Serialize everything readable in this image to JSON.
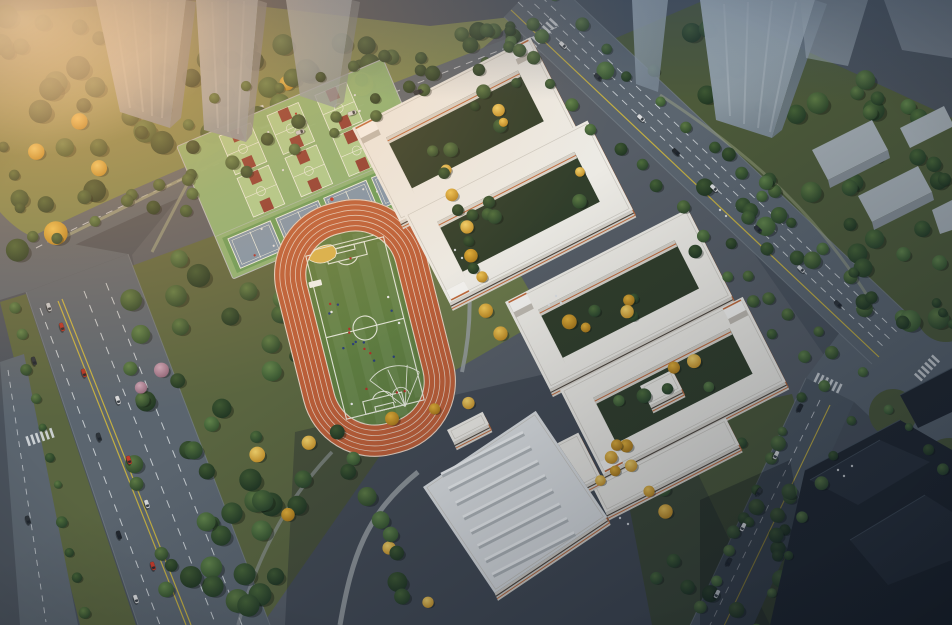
{
  "scene": {
    "type": "architectural-aerial-rendering",
    "subject": "school campus bird's-eye view at dusk",
    "lighting": "warm sunset glow from upper-left, cool blue dusk shadow toward lower-right",
    "inventory": {
      "running_track": 1,
      "soccer_field": 1,
      "long_jump_sand_pit": 1,
      "throwing_sector": 1,
      "basketball_courts": 6,
      "blue_courts": 4,
      "courtyard_teaching_building_complexes": 2,
      "annex_buildings": 3,
      "gymnasium_with_ribbed_roof": 1,
      "glass_towers_top": 7,
      "dark_towers_bottom_right": 3,
      "roads": [
        "left boulevard with planted median",
        "top perimeter road",
        "right arterial road",
        "bottom-right road",
        "signalized intersection with zebra crossings"
      ]
    }
  },
  "palette": {
    "base": "#4a525c",
    "campus": "#565d66",
    "parkGrass": "#7a8650",
    "parkGrassDark": "#5a6540",
    "forestGrass": "#4d5a3a",
    "road": "#5b656f",
    "roadDark": "#4e5862",
    "laneWhite": "#d6dade",
    "laneYellow": "#c2ae42",
    "sidewalk": "#79828b",
    "trackOrange": "#bb5e38",
    "trackLine": "#eadfd2",
    "infield": "#5f7d41",
    "pitchLine": "#e8eadf",
    "sand": "#d8b24c",
    "padGreen": "#8cb677",
    "bbCourt": "#a9cd91",
    "bbKey": "#8c3a31",
    "courtLine": "#edf2e8",
    "tnStrip": "#679d5a",
    "tnCourt": "#7d95ac",
    "roofWhite": "#eceae4",
    "gymRoof": "#dde0e2",
    "wallLight": "#d6d2ca",
    "wallDark": "#beb9b0",
    "accentOrange": "#bf6a3c",
    "windowDark": "#4d453c",
    "courtyard": "#313e2b",
    "towerFace": "#7d8a96",
    "lowrise": "#a2abb1",
    "lowriseSide": "#828b92",
    "darkTower": "#21272f",
    "darkTower2": "#2b323c",
    "darkTowerEdge": "#4a5560",
    "gymRib": "#eff1f2",
    "gymRibShade": "#b2b7ba",
    "pathGray": "#999fa2",
    "pathPark": "#a2a887",
    "glow": "#ffb066",
    "glowCore": "#ffdcae",
    "dusk": "#0a1423",
    "topCool": "#32445c",
    "flagRed": "#c13227",
    "playerRed": "#b03028",
    "playerBlue": "#2a3e7a",
    "playerWhite": "#e8e8e8",
    "pedestrian": "#dde0e3",
    "bumpWhite": "#f4f3f0"
  },
  "sports": {
    "track_lanes": 6,
    "lane_width": 5.2,
    "field_players": 22,
    "court_players": 14,
    "basketball": {
      "rows": 2,
      "cols": 3,
      "court_w": 34,
      "court_h": 42,
      "row_centers": [
        -44,
        2
      ],
      "col_centers": [
        -52,
        0,
        52
      ]
    },
    "tennis": {
      "count": 4,
      "court_w": 46,
      "court_h": 32,
      "centers_x": [
        -78,
        -26,
        26,
        78
      ],
      "center_y": 49,
      "strip": [
        -106,
        30,
        212,
        38
      ]
    }
  },
  "buildings": [
    {
      "name": "teaching-building-a-north-ring",
      "ang": -27,
      "o": [
        352,
        128
      ],
      "U": 200,
      "V": 105,
      "iU": 26,
      "iV": 24,
      "courtyard": true,
      "bumps": [
        0,
        1
      ],
      "roof": "roofWhite"
    },
    {
      "name": "teaching-building-a-south-ring",
      "ang": -27,
      "o": [
        404,
        214
      ],
      "U": 206,
      "V": 100,
      "iU": 26,
      "iV": 22,
      "courtyard": true,
      "bumps": [
        3
      ],
      "roof": "roofWhite"
    },
    {
      "name": "teaching-building-b-north-ring",
      "ang": -27,
      "o": [
        505,
        302
      ],
      "U": 205,
      "V": 98,
      "iU": 26,
      "iV": 22,
      "courtyard": true,
      "bumps": [
        0
      ],
      "roof": "roofWhite"
    },
    {
      "name": "teaching-building-b-south-ring",
      "ang": -27,
      "o": [
        560,
        390
      ],
      "U": 205,
      "V": 95,
      "iU": 26,
      "iV": 22,
      "courtyard": true,
      "bumps": [
        3,
        1
      ],
      "roof": "roofWhite"
    },
    {
      "name": "annex-bar-long",
      "ang": -27,
      "o": [
        592,
        486
      ],
      "U": 150,
      "V": 30,
      "courtyard": false,
      "bumps": [],
      "roof": "roofWhite"
    },
    {
      "name": "annex-bar-short",
      "ang": -27,
      "o": [
        548,
        448
      ],
      "U": 34,
      "V": 50,
      "courtyard": false,
      "bumps": [],
      "roof": "roofWhite"
    },
    {
      "name": "annex-block-small",
      "ang": -27,
      "o": [
        640,
        386
      ],
      "U": 36,
      "V": 22,
      "courtyard": false,
      "bumps": [],
      "roof": "roofWhite"
    },
    {
      "name": "gymnasium",
      "ang": -34,
      "o": [
        423,
        487
      ],
      "U": 136,
      "V": 128,
      "courtyard": false,
      "bumps": [],
      "roof": "gymRoof"
    },
    {
      "name": "entrance-canopy",
      "ang": -27,
      "o": [
        447,
        430
      ],
      "U": 40,
      "V": 14,
      "courtyard": false,
      "bumps": [],
      "roof": "roofWhite"
    }
  ],
  "gym_ribs": {
    "count": 8,
    "start": [
      441,
      474
    ],
    "step": [
      7.3,
      14.3
    ],
    "len": [
      82,
      -41.8
    ]
  },
  "vegetation": {
    "greens": [
      [
        "#5d7a44",
        "#2c452a"
      ],
      [
        "#4f6e3c",
        "#27402a"
      ],
      [
        "#466337",
        "#233a26"
      ],
      [
        "#60824a",
        "#33502e"
      ],
      [
        "#3e5832",
        "#1f3422"
      ]
    ],
    "yellows": [
      [
        "#eec455",
        "#b5821f"
      ],
      [
        "#e0ae39",
        "#a37318"
      ],
      [
        "#f0d06a",
        "#c08c26"
      ]
    ],
    "pink": [
      "#c9a3b4",
      "#8f6478"
    ],
    "patches": [
      {
        "layer": "back",
        "kind": "mixg",
        "poly": [
          [
            0,
            12
          ],
          [
            205,
            0
          ],
          [
            430,
            26
          ],
          [
            520,
            16
          ],
          [
            432,
            92
          ],
          [
            236,
            140
          ],
          [
            58,
            250
          ],
          [
            0,
            266
          ]
        ],
        "n": 64,
        "rmin": 6,
        "rmax": 12
      },
      {
        "layer": "back",
        "kind": "g",
        "poly": [
          [
            126,
            266
          ],
          [
            322,
            196
          ],
          [
            402,
            424
          ],
          [
            262,
            625
          ],
          [
            166,
            625
          ],
          [
            116,
            420
          ]
        ],
        "n": 58,
        "rmin": 6,
        "rmax": 12
      },
      {
        "layer": "back",
        "kind": "y",
        "poly": [
          [
            200,
            420
          ],
          [
            330,
            380
          ],
          [
            360,
            480
          ],
          [
            240,
            560
          ]
        ],
        "n": 3,
        "rmin": 6,
        "rmax": 8
      },
      {
        "layer": "back",
        "kind": "p",
        "poly": [
          [
            130,
            300
          ],
          [
            230,
            330
          ],
          [
            210,
            420
          ],
          [
            120,
            400
          ]
        ],
        "n": 2,
        "rmin": 6,
        "rmax": 8
      },
      {
        "layer": "back",
        "kind": "g",
        "poly": [
          [
            560,
            60
          ],
          [
            700,
            2
          ],
          [
            952,
            118
          ],
          [
            952,
            332
          ],
          [
            878,
            348
          ],
          [
            636,
            132
          ]
        ],
        "n": 52,
        "rmin": 6,
        "rmax": 11
      },
      {
        "layer": "back",
        "kind": "g",
        "poly": [
          [
            615,
            432
          ],
          [
            790,
            395
          ],
          [
            842,
            560
          ],
          [
            842,
            625
          ],
          [
            652,
            625
          ]
        ],
        "n": 26,
        "rmin": 5,
        "rmax": 9
      },
      {
        "layer": "back",
        "kind": "g",
        "poly": [
          [
            360,
            52
          ],
          [
            560,
            12
          ],
          [
            640,
            40
          ],
          [
            470,
            90
          ]
        ],
        "n": 10,
        "rmin": 5,
        "rmax": 8
      },
      {
        "layer": "front",
        "kind": "mix",
        "poly": [
          [
            386,
            138
          ],
          [
            518,
            71
          ],
          [
            544,
            122
          ],
          [
            412,
            189
          ]
        ],
        "n": 7,
        "rmin": 4.5,
        "rmax": 7.5
      },
      {
        "layer": "front",
        "kind": "mix",
        "poly": [
          [
            437,
            222
          ],
          [
            574,
            152
          ],
          [
            599,
            202
          ],
          [
            462,
            272
          ]
        ],
        "n": 7,
        "rmin": 4.5,
        "rmax": 7.5
      },
      {
        "layer": "front",
        "kind": "mix",
        "poly": [
          [
            538,
            310
          ],
          [
            674,
            241
          ],
          [
            697,
            285
          ],
          [
            561,
            354
          ]
        ],
        "n": 7,
        "rmin": 4.5,
        "rmax": 7.5
      },
      {
        "layer": "front",
        "kind": "mix",
        "poly": [
          [
            593,
            398
          ],
          [
            729,
            328
          ],
          [
            750,
            370
          ],
          [
            614,
            440
          ]
        ],
        "n": 7,
        "rmin": 4.5,
        "rmax": 7.5
      },
      {
        "layer": "front",
        "kind": "y",
        "poly": [
          [
            560,
            470
          ],
          [
            640,
            432
          ],
          [
            663,
            456
          ],
          [
            585,
            496
          ]
        ],
        "n": 4,
        "rmin": 5,
        "rmax": 7
      }
    ],
    "belts": [
      {
        "layer": "front",
        "kind": "g",
        "pts": [
          [
            505,
            44
          ],
          [
            858,
            374
          ]
        ],
        "n": 17,
        "rmin": 5,
        "rmax": 7,
        "jit": 7
      },
      {
        "layer": "front",
        "kind": "g",
        "pts": [
          [
            550,
            -2
          ],
          [
            903,
            328
          ]
        ],
        "n": 14,
        "rmin": 5,
        "rmax": 7,
        "jit": 6
      },
      {
        "layer": "front",
        "kind": "g",
        "pts": [
          [
            60,
            236
          ],
          [
            540,
            20
          ]
        ],
        "n": 15,
        "rmin": 5,
        "rmax": 8,
        "jit": 7
      },
      {
        "layer": "front",
        "kind": "g",
        "pts": [
          [
            150,
            208
          ],
          [
            520,
            56
          ]
        ],
        "n": 9,
        "rmin": 5,
        "rmax": 7,
        "jit": 6
      },
      {
        "layer": "front",
        "kind": "g",
        "pts": [
          [
            14,
            306
          ],
          [
            86,
            610
          ]
        ],
        "n": 11,
        "rmin": 4,
        "rmax": 6,
        "jit": 4
      },
      {
        "layer": "front",
        "kind": "g",
        "pts": [
          [
            798,
            402
          ],
          [
            704,
            608
          ]
        ],
        "n": 8,
        "rmin": 4.5,
        "rmax": 7,
        "jit": 5
      },
      {
        "layer": "front",
        "kind": "g",
        "pts": [
          [
            848,
            418
          ],
          [
            758,
            625
          ]
        ],
        "n": 7,
        "rmin": 4.5,
        "rmax": 7,
        "jit": 5
      },
      {
        "layer": "front",
        "kind": "y",
        "pts": [
          [
            447,
            168
          ],
          [
            500,
            338
          ]
        ],
        "n": 7,
        "rmin": 5.5,
        "rmax": 7.5,
        "jit": 6
      },
      {
        "layer": "front",
        "kind": "y",
        "pts": [
          [
            396,
            420
          ],
          [
            470,
            402
          ]
        ],
        "n": 3,
        "rmin": 5.5,
        "rmax": 7.5,
        "jit": 4
      },
      {
        "layer": "front",
        "kind": "y",
        "pts": [
          [
            618,
            448
          ],
          [
            666,
            512
          ]
        ],
        "n": 4,
        "rmin": 5.5,
        "rmax": 7.5,
        "jit": 5
      },
      {
        "layer": "front",
        "kind": "y",
        "pts": [
          [
            386,
            548
          ],
          [
            428,
            602
          ]
        ],
        "n": 2,
        "rmin": 5.5,
        "rmax": 7,
        "jit": 4
      },
      {
        "layer": "front",
        "kind": "g",
        "pts": [
          [
            192,
            122
          ],
          [
            186,
            206
          ]
        ],
        "n": 4,
        "rmin": 5,
        "rmax": 7,
        "jit": 5
      },
      {
        "layer": "front",
        "kind": "g",
        "pts": [
          [
            214,
            98
          ],
          [
            420,
            52
          ]
        ],
        "n": 7,
        "rmin": 5,
        "rmax": 7,
        "jit": 6
      },
      {
        "layer": "front",
        "kind": "g",
        "pts": [
          [
            432,
            148
          ],
          [
            476,
            268
          ]
        ],
        "n": 5,
        "rmin": 5,
        "rmax": 7,
        "jit": 5
      },
      {
        "layer": "front",
        "kind": "g",
        "pts": [
          [
            698,
            252
          ],
          [
            826,
            388
          ]
        ],
        "n": 6,
        "rmin": 5,
        "rmax": 7,
        "jit": 6
      },
      {
        "layer": "front",
        "kind": "g",
        "pts": [
          [
            338,
            436
          ],
          [
            410,
            596
          ]
        ],
        "n": 9,
        "rmin": 6,
        "rmax": 10,
        "jit": 8
      },
      {
        "layer": "front",
        "kind": "g",
        "pts": [
          [
            890,
            412
          ],
          [
            942,
            468
          ]
        ],
        "n": 4,
        "rmin": 4,
        "rmax": 6,
        "jit": 4
      },
      {
        "layer": "front",
        "kind": "g",
        "pts": [
          [
            938,
            302
          ],
          [
            952,
            322
          ]
        ],
        "n": 3,
        "rmin": 4,
        "rmax": 5,
        "jit": 3
      },
      {
        "layer": "front",
        "kind": "g",
        "pts": [
          [
            6,
            146
          ],
          [
            30,
            236
          ]
        ],
        "n": 4,
        "rmin": 5,
        "rmax": 7,
        "jit": 4
      }
    ]
  },
  "cars": [
    [
      49,
      307,
      71,
      "#c3c8cc"
    ],
    [
      62,
      327,
      71,
      "#b23527"
    ],
    [
      34,
      361,
      71,
      "#2e343a"
    ],
    [
      84,
      373,
      71,
      "#b23527"
    ],
    [
      118,
      400,
      71,
      "#d8dadc"
    ],
    [
      99,
      437,
      71,
      "#2e343a"
    ],
    [
      129,
      460,
      71,
      "#c23b2b"
    ],
    [
      147,
      504,
      71,
      "#d8dadc"
    ],
    [
      119,
      535,
      71,
      "#23282e"
    ],
    [
      153,
      566,
      71,
      "#c23b2b"
    ],
    [
      136,
      599,
      71,
      "#d8dadc"
    ],
    [
      28,
      520,
      71,
      "#2e343a"
    ],
    [
      563,
      45,
      43,
      "#d8dadc"
    ],
    [
      598,
      77,
      43,
      "#2e343a"
    ],
    [
      641,
      118,
      43,
      "#d8dadc"
    ],
    [
      676,
      152,
      43,
      "#23282e"
    ],
    [
      714,
      188,
      43,
      "#d8dadc"
    ],
    [
      758,
      229,
      43,
      "#2e343a"
    ],
    [
      801,
      269,
      43,
      "#c6cace"
    ],
    [
      838,
      304,
      43,
      "#2e343a"
    ],
    [
      800,
      408,
      116,
      "#23282e"
    ],
    [
      776,
      455,
      116,
      "#d8dadc"
    ],
    [
      759,
      492,
      116,
      "#2e343a"
    ],
    [
      743,
      527,
      116,
      "#d8dadc"
    ],
    [
      729,
      562,
      116,
      "#23282e"
    ],
    [
      717,
      594,
      116,
      "#c2c6ca"
    ],
    [
      352,
      113,
      -19,
      "#d8dadc"
    ],
    [
      300,
      132,
      -19,
      "#c9ccd0"
    ],
    [
      418,
      92,
      -19,
      "#2e343a"
    ]
  ],
  "crosswalks": [
    [
      543,
      33,
      43,
      7
    ],
    [
      40,
      437,
      71,
      6
    ],
    [
      828,
      383,
      116,
      6
    ],
    [
      927,
      368,
      43,
      6
    ],
    [
      262,
      117,
      -19,
      5
    ]
  ],
  "pedestrians": [
    [
      556,
      296
    ],
    [
      561,
      303
    ],
    [
      549,
      305
    ],
    [
      838,
      470
    ],
    [
      844,
      476
    ],
    [
      852,
      466
    ],
    [
      620,
      518
    ],
    [
      628,
      524
    ],
    [
      455,
      250
    ],
    [
      462,
      258
    ],
    [
      720,
      210
    ],
    [
      726,
      216
    ]
  ]
}
